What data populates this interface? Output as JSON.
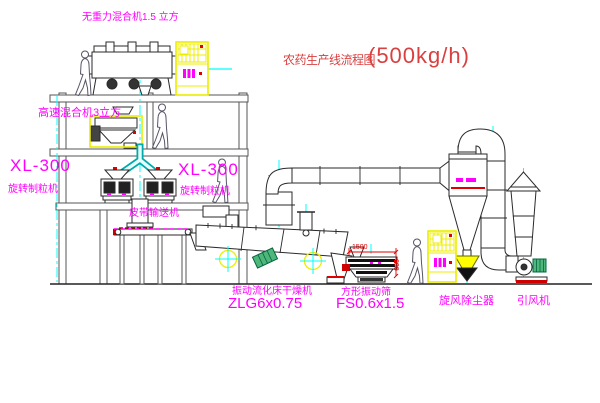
{
  "title": {
    "text": "农药生产线流程图",
    "capacity": "(500kg/h)"
  },
  "equipment_labels": {
    "gravity_mixer": "无重力混合机1.5 立方",
    "high_speed_mixer": "高速混合机3立方",
    "granulator_left_model": "XL-300",
    "granulator_left_name": "旋转制粒机",
    "granulator_right_model": "XL-300",
    "granulator_right_name": "旋转制粒机",
    "belt_conveyor": "皮带输送机",
    "fluid_bed_dryer_name": "振动流化床干燥机",
    "fluid_bed_dryer_model": "ZLG6x0.75",
    "vibrating_screen_name": "方形振动筛",
    "vibrating_screen_model": "FS0.6x1.5",
    "cyclone": "旋风除尘器",
    "induced_draft_fan": "引风机"
  },
  "dimensions": {
    "screen_length": "1500",
    "screen_width": "600"
  },
  "colors": {
    "label_magenta": "#ff00ff",
    "title_red": "#d94040",
    "dimension_red": "#e00000",
    "cabinet_yellow": "#ffff00",
    "pipe_cyan": "#00ffff",
    "motor_green": "#4db87a"
  }
}
